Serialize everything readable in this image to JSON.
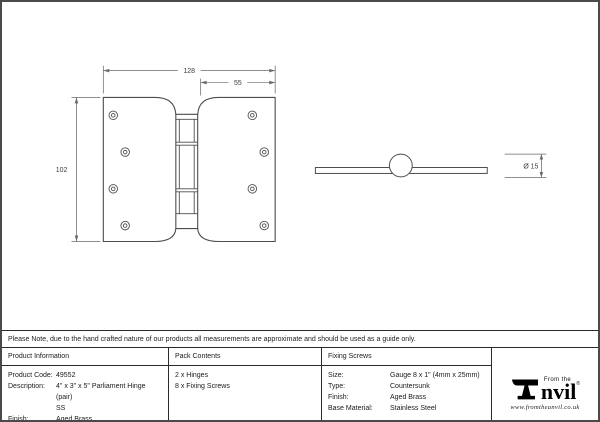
{
  "drawing": {
    "front_view": {
      "dim_width": "128",
      "dim_inner": "55",
      "dim_height": "102"
    },
    "side_view": {
      "dim_diameter": "Ø 15"
    }
  },
  "note": "Please Note, due to the hand crafted nature of our products all measurements are approximate and should be used as a guide only.",
  "table": {
    "product_information": {
      "header": "Product Information",
      "rows": [
        {
          "label": "Product Code:",
          "value": "49552"
        },
        {
          "label": "Description:",
          "value": "4\" x 3\" x 5\" Parliament Hinge (pair)",
          "value2": "SS"
        },
        {
          "label": "Finish:",
          "value": "Aged Brass"
        },
        {
          "label": "Base Material:",
          "value": "Stainless Steel"
        }
      ]
    },
    "pack_contents": {
      "header": "Pack Contents",
      "items": [
        "2 x Hinges",
        "8 x Fixing Screws"
      ]
    },
    "fixing_screws": {
      "header": "Fixing Screws",
      "rows": [
        {
          "label": "Size:",
          "value": "Gauge 8 x 1\" (4mm x 25mm)"
        },
        {
          "label": "Type:",
          "value": "Countersunk"
        },
        {
          "label": "Finish:",
          "value": "Aged Brass"
        },
        {
          "label": "Base Material:",
          "value": "Stainless Steel"
        }
      ]
    }
  },
  "logo": {
    "tagline": "From the",
    "name_rest": "nvil",
    "registered": "®",
    "website": "www.fromtheanvil.co.uk"
  },
  "colors": {
    "line": "#4d4d4d",
    "dim_line": "#6a6a6a",
    "border": "#2a2a2a",
    "ink": "#1a1a1a"
  }
}
